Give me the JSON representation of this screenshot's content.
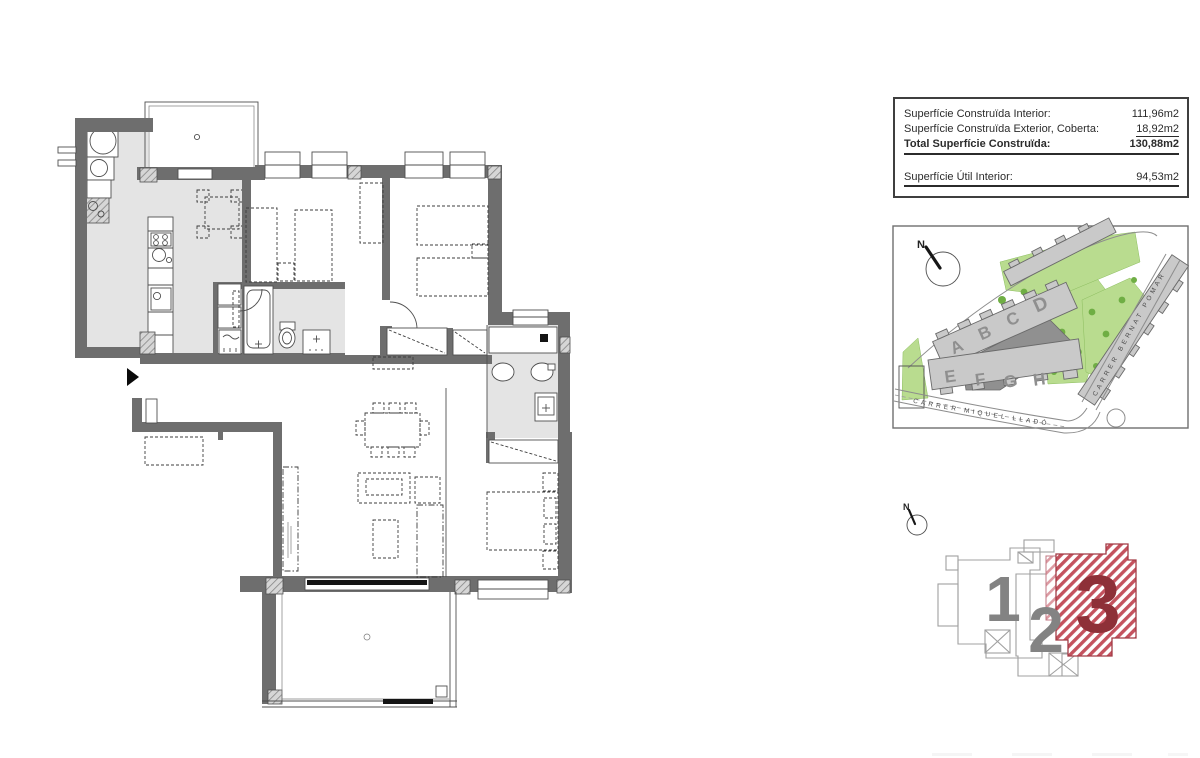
{
  "info_panel": {
    "rows": [
      {
        "label": "Superfície Construïda Interior:",
        "value": "111,96m2"
      },
      {
        "label": "Superfície Construïda Exterior, Coberta:",
        "value": "18,92m2"
      },
      {
        "label": "Total Superfície Construïda:",
        "value": "130,88m2"
      }
    ],
    "util_row": {
      "label": "Superfície Útil Interior:",
      "value": "94,53m2"
    }
  },
  "site_plan": {
    "north_label": "N",
    "blocks_top": [
      "A",
      "B",
      "C",
      "D"
    ],
    "blocks_bottom": [
      "E",
      "F",
      "G",
      "H"
    ],
    "highlighted_block": "D",
    "streets": {
      "bottom": "CARRER MIQUEL LLADÓ",
      "right": "CARRER BERNAT POMAR"
    }
  },
  "key_plan": {
    "north_label": "N",
    "units": [
      "1",
      "2",
      "3"
    ],
    "highlighted_unit": "3"
  },
  "colors": {
    "wall_gray": "#6e6e6e",
    "floor_gray": "#e4e4e4",
    "accent_red": "#c9252b",
    "key_unit_red": "#8e3038",
    "pool_blue": "#2fa9df",
    "vegetation_green": "#aed581",
    "building_gray": "#c9c9c9",
    "letter_gray": "#8f8f8f"
  }
}
